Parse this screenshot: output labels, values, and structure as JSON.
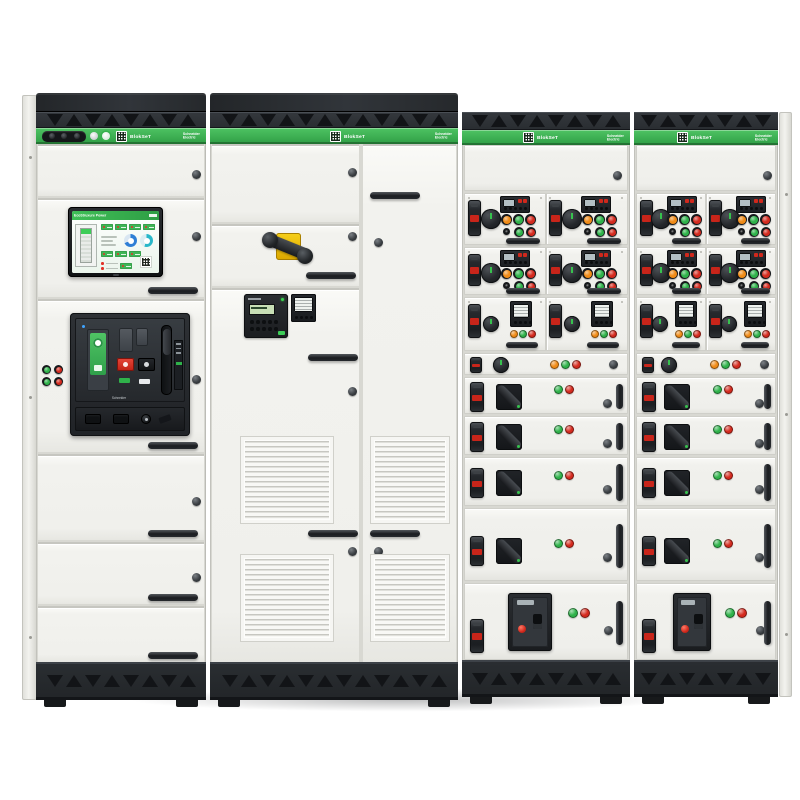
{
  "brand": {
    "product_label": "BlokSeT",
    "maker_line1": "Schneider",
    "maker_line2": "Electric"
  },
  "hmi": {
    "header_title": "EcoStruxure Power"
  },
  "palette": {
    "brand_green": "#3dcd58",
    "band_green_top": "#4ec363",
    "band_green_bottom": "#2f9e45",
    "button_green": "#2fb24a",
    "button_red": "#d42a1e",
    "button_orange": "#f08b17",
    "panel_white": "#f0f0ec",
    "frame_dark": "#26292d",
    "handle_yellow": "#eec30d",
    "gauge_blue": "#2f7fd6",
    "gauge_teal": "#29b7c9"
  },
  "feeder_cabinets": [
    {
      "left": 462,
      "width": 168
    },
    {
      "left": 634,
      "width": 144
    }
  ],
  "feeder_rows": [
    {
      "kind": "blank",
      "h": 46
    },
    {
      "kind": "starters",
      "h": 52,
      "buttons": [
        "orange",
        "green",
        "red",
        "black",
        "green",
        "red"
      ]
    },
    {
      "kind": "starters",
      "h": 48,
      "buttons": [
        "orange",
        "green",
        "red",
        "black",
        "green",
        "red"
      ]
    },
    {
      "kind": "meters",
      "h": 54,
      "lights": [
        "orange",
        "green",
        "red"
      ]
    },
    {
      "kind": "strip",
      "h": 22,
      "lights": [
        "orange",
        "green",
        "red"
      ]
    },
    {
      "kind": "feeder",
      "h": 37,
      "lights": [
        "green",
        "red"
      ]
    },
    {
      "kind": "feeder",
      "h": 39,
      "lights": [
        "green",
        "red"
      ]
    },
    {
      "kind": "feeder",
      "h": 49,
      "lights": [
        "green",
        "red"
      ]
    },
    {
      "kind": "feeder",
      "h": 73,
      "lights": [
        "green",
        "red"
      ],
      "tall": true
    },
    {
      "kind": "mccb",
      "h": 77,
      "lights": [
        "green",
        "red"
      ]
    }
  ]
}
